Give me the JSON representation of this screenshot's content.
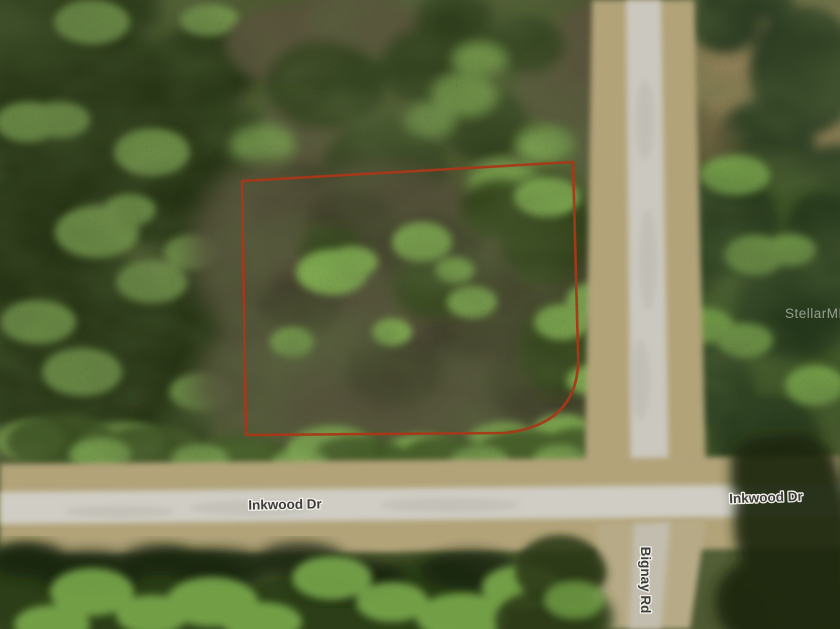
{
  "map": {
    "type": "satellite-aerial-view",
    "road_labels": [
      {
        "id": "inkwood-left",
        "text": "Inkwood Dr"
      },
      {
        "id": "inkwood-right",
        "text": "Inkwood Dr"
      },
      {
        "id": "bignay",
        "text": "Bignay Rd"
      }
    ],
    "watermark_text": "StellarMLS",
    "parcel": {
      "boundary_color": "#a83818",
      "description": "red outlined vacant lot, rounded bottom-right corner"
    },
    "colors": {
      "label_fill": "#3d3d3d",
      "label_halo": "#f3f1e8",
      "watermark_fill": "#ffffff",
      "road_pavement": "#cdcac1",
      "road_shoulder": "#b2a379",
      "forest_dark": "#1d2b11",
      "scrub_brown": "#55503b",
      "shrub_green": "#83b152"
    }
  }
}
